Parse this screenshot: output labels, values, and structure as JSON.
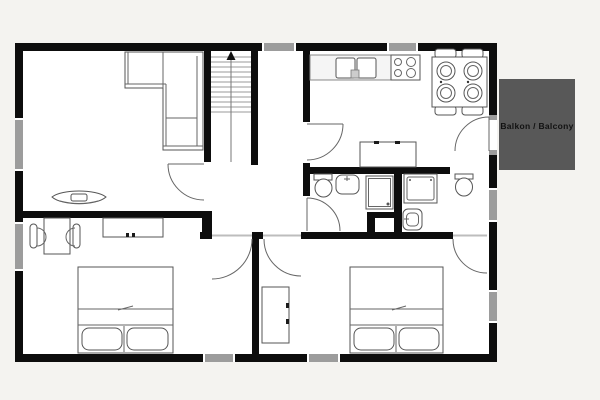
{
  "plan": {
    "balcony": {
      "label": "Balkon / Balcony"
    },
    "colors": {
      "page_bg": "#f4f3f0",
      "floor": "#ffffff",
      "wall": "#0d0d0d",
      "window": "#9c9c9c",
      "balcony_bg": "#585858",
      "balcony_text": "#111111",
      "furniture_outline": "#555555"
    }
  }
}
